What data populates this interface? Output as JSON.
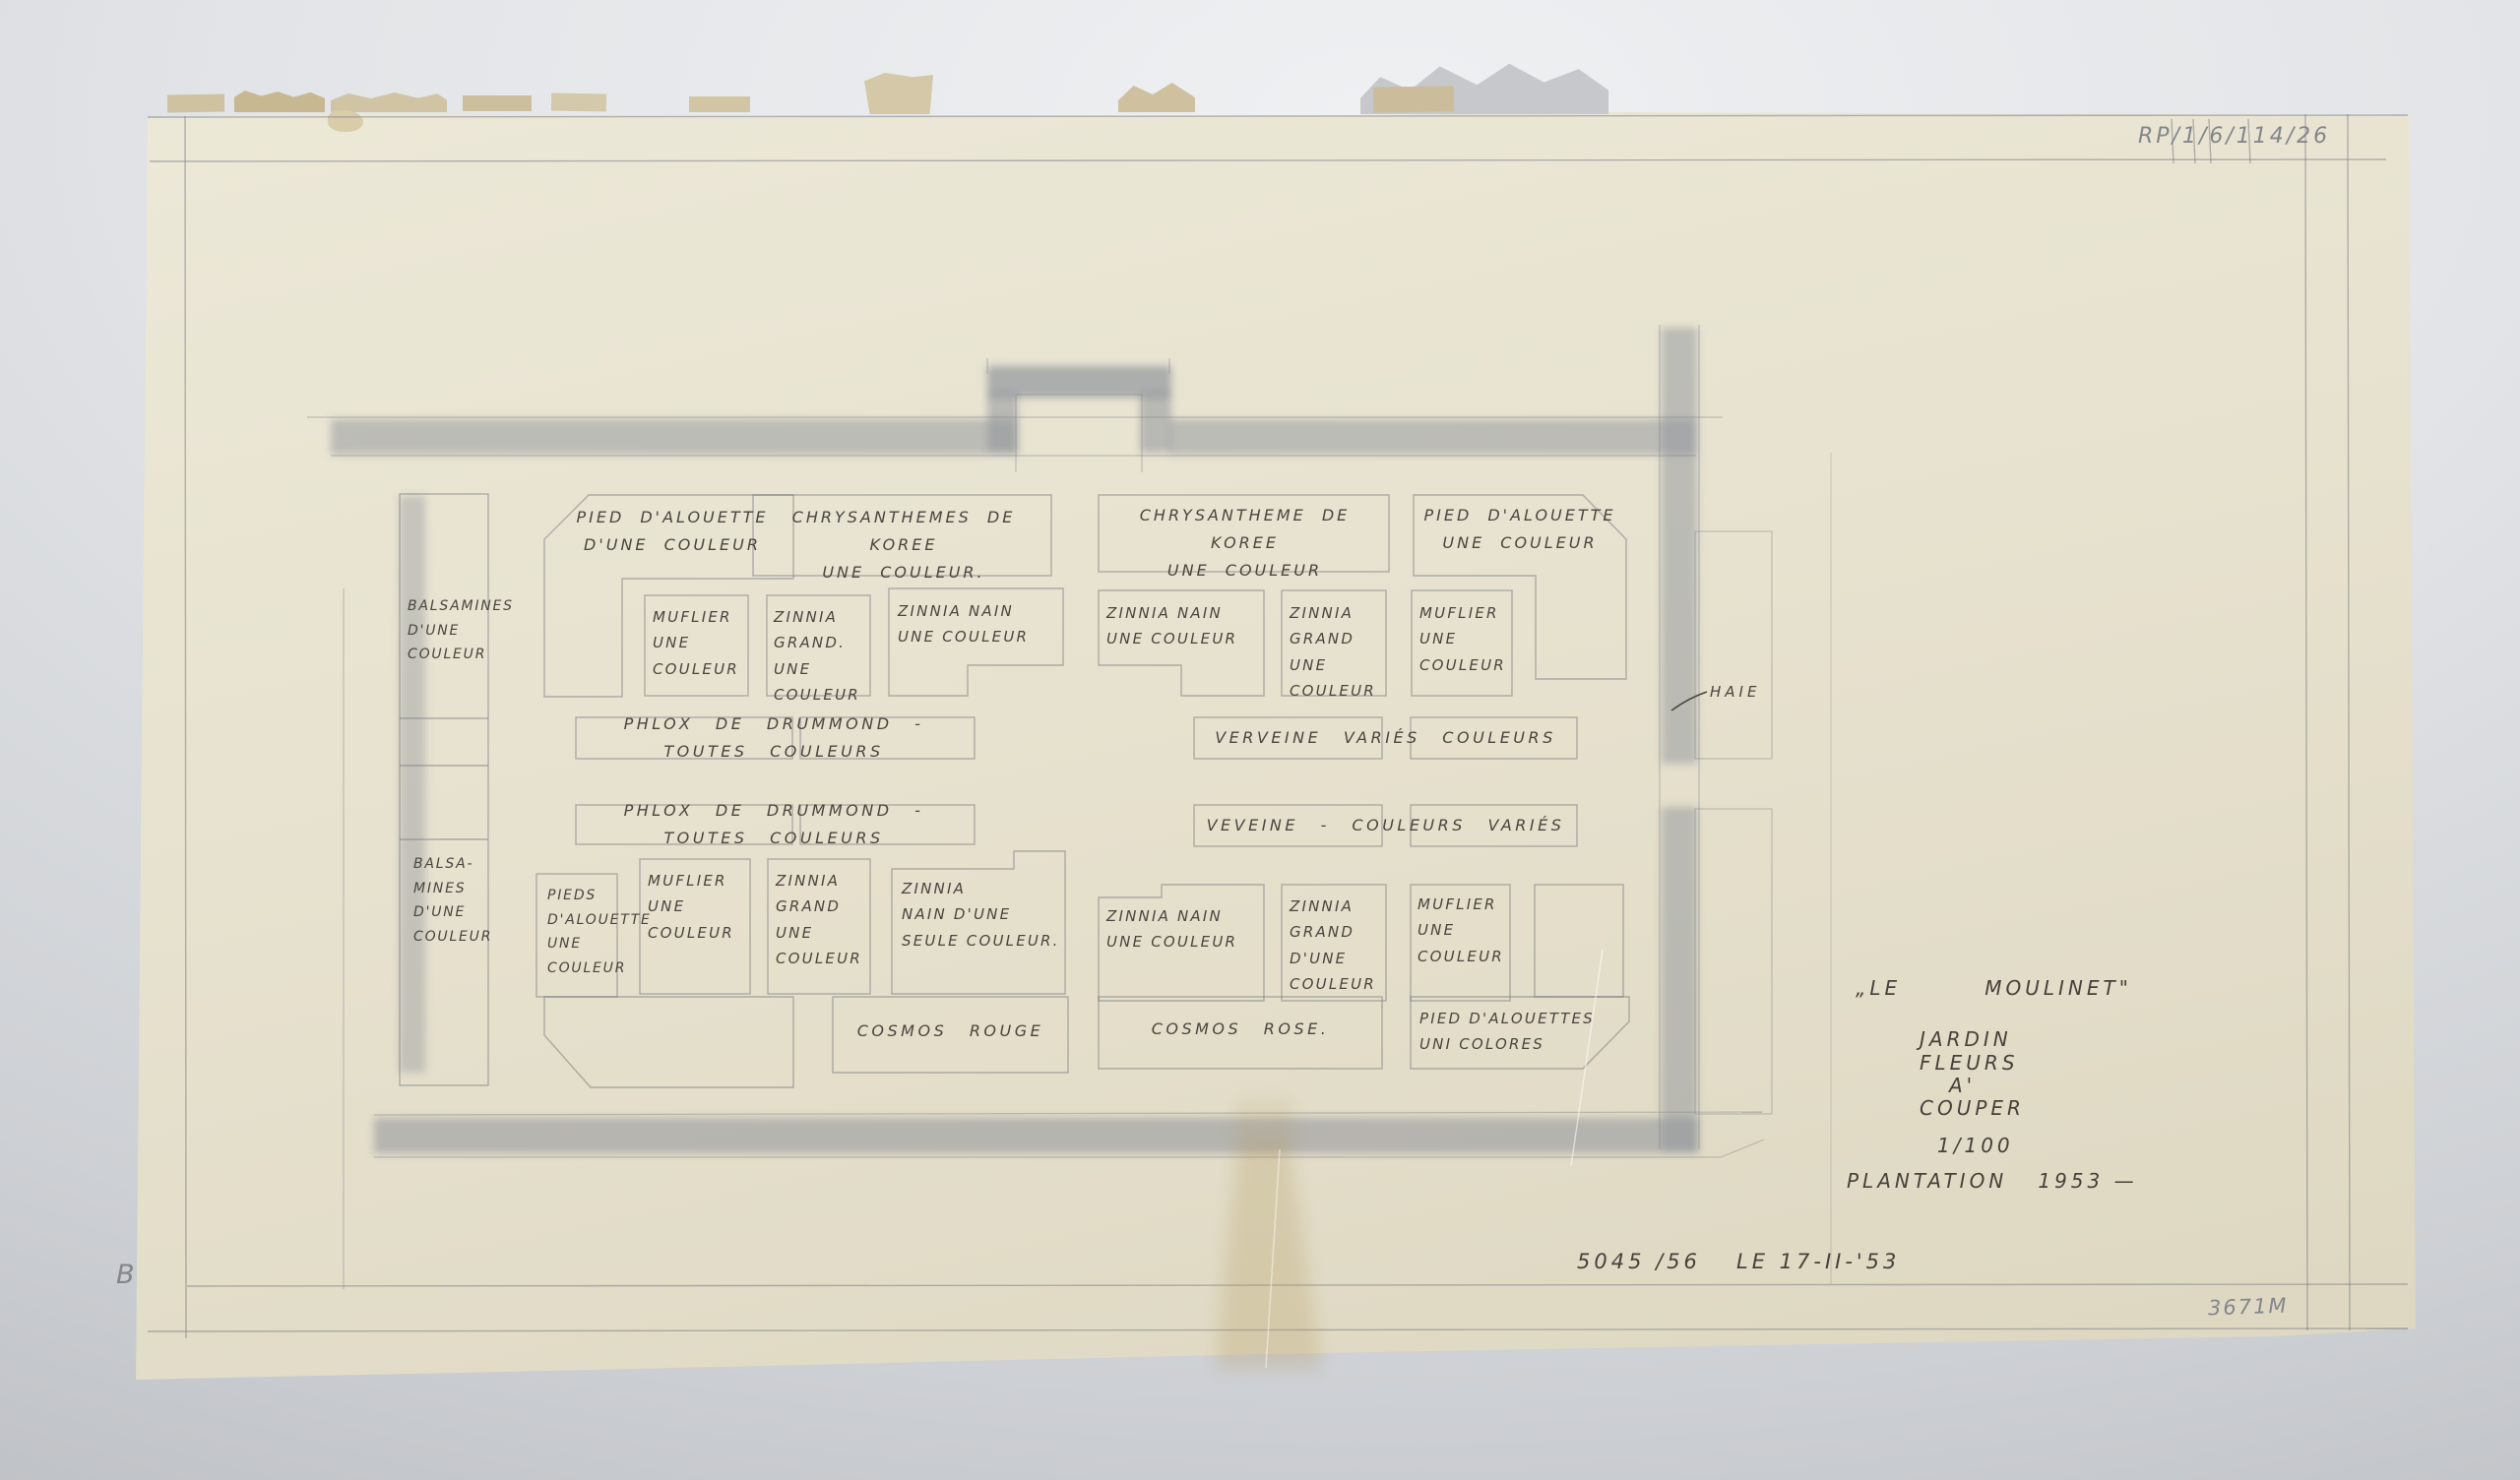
{
  "stamps": {
    "archive_code": "RP/1/6/114/26",
    "bottom_right_code": "3671M",
    "corner_mark": "B"
  },
  "title_block": {
    "title": "„LE   MOULINET\"",
    "lines": [
      "JARDIN",
      "FLEURS",
      "A'",
      "COUPER"
    ],
    "scale": "1/100",
    "plantation": "PLANTATION   1953 —"
  },
  "footer": {
    "reference": "5045 /56",
    "date": "LE 17-II-'53"
  },
  "annotations": {
    "haie": "HAIE"
  },
  "beds": {
    "balsamines_n": "BALSAMINES\nD'UNE\nCOULEUR",
    "balsamines_s": "BALSA-\nMINES\nD'UNE\nCOULEUR",
    "pied_alouette_nw": "PIED D'ALOUETTE\nD'UNE COULEUR",
    "chrysanthemes_nw": "CHRYSANTHEMES DE KOREE\nUNE COULEUR.",
    "chrysantheme_ne": "CHRYSANTHEME DE KOREE\nUNE COULEUR",
    "pied_alouette_ne": "PIED D'ALOUETTE\nUNE COULEUR",
    "muflier_w1": "MUFLIER\nUNE\nCOULEUR",
    "zinnia_grand_w1": "ZINNIA\nGRAND.\nUNE COULEUR",
    "zinnia_nain_w1": "ZINNIA  NAIN\nUNE COULEUR",
    "zinnia_nain_e1": "ZINNIA NAIN\nUNE COULEUR",
    "zinnia_grand_e1": "ZINNIA\nGRAND\nUNE COULEUR",
    "muflier_e1": "MUFLIER\nUNE\nCOULEUR",
    "phlox_1": "PHLOX DE DRUMMOND - TOUTES COULEURS",
    "verveine_1": "VERVEINE  VARIÉS  COULEURS",
    "phlox_2": "PHLOX DE DRUMMOND - TOUTES COULEURS",
    "verveine_2": "VEVEINE - COULEURS  VARIÉS",
    "pieds_alouette_sw": "PIEDS\nD'ALOUETTE\nUNE\nCOULEUR",
    "muflier_w2": "MUFLIER\nUNE COULEUR",
    "zinnia_grand_w2": "ZINNIA\nGRAND\nUNE COULEUR",
    "zinnia_nain_w2": "ZINNIA\nNAIN D'UNE\nSEULE COULEUR.",
    "zinnia_nain_e2": "ZINNIA NAIN\nUNE COULEUR",
    "zinnia_grand_e2": "ZINNIA\nGRAND\nD'UNE COULEUR",
    "muflier_e2": "MUFLIER\nUNE COULEUR",
    "cosmos_rouge": "COSMOS  ROUGE",
    "cosmos_rose": "COSMOS  ROSE.",
    "pied_alouettes_se": "PIED D'ALOUETTES\nUNI COLORES"
  },
  "colors": {
    "paper": "#e8e3d0",
    "background": "#d9dbdf",
    "ink": "#4a453e",
    "pencil": "#84878c",
    "hedge": "#8f939b",
    "stain": "#b39a5e"
  }
}
